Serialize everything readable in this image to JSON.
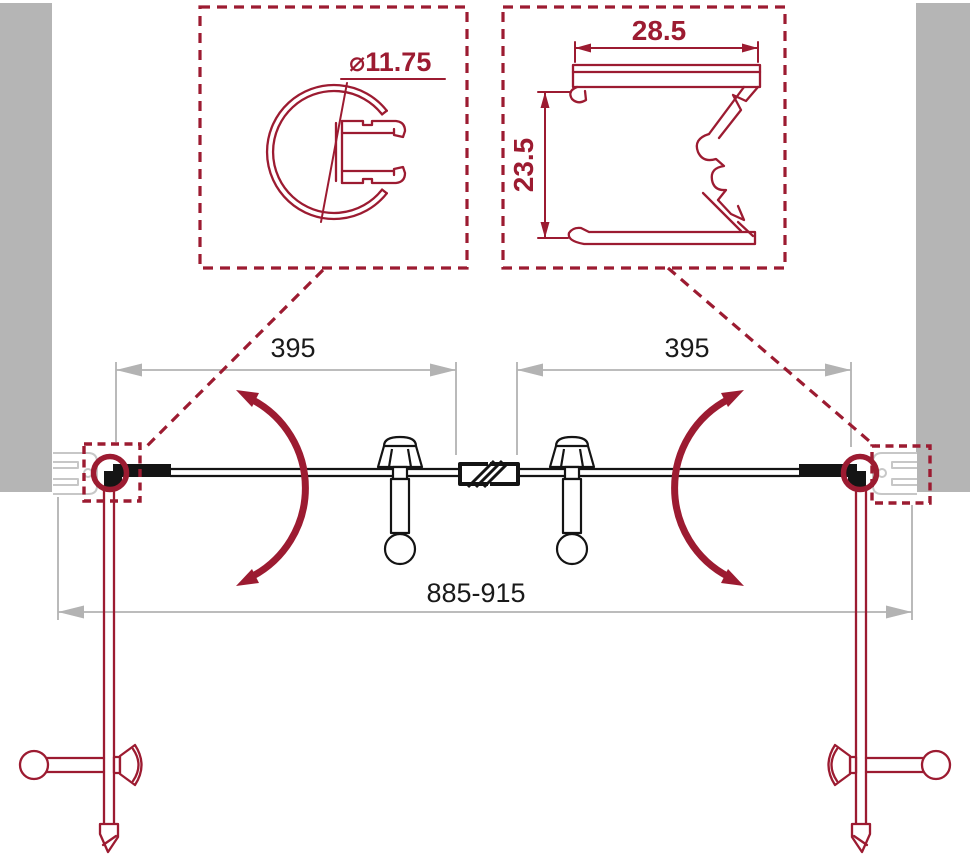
{
  "colors": {
    "accent_red": "#9C1B31",
    "wall_gray": "#B5B5B5",
    "profile_gray": "#C7C7C7",
    "dimension_gray": "#B3B3B3",
    "line_black": "#141414"
  },
  "details": {
    "knob_profile": {
      "diameter_label": "⌀11.75"
    },
    "wall_profile": {
      "width_label": "28.5",
      "height_label": "23.5"
    }
  },
  "plan": {
    "left_door_width": "395",
    "right_door_width": "395",
    "overall_width_range": "885-915"
  }
}
